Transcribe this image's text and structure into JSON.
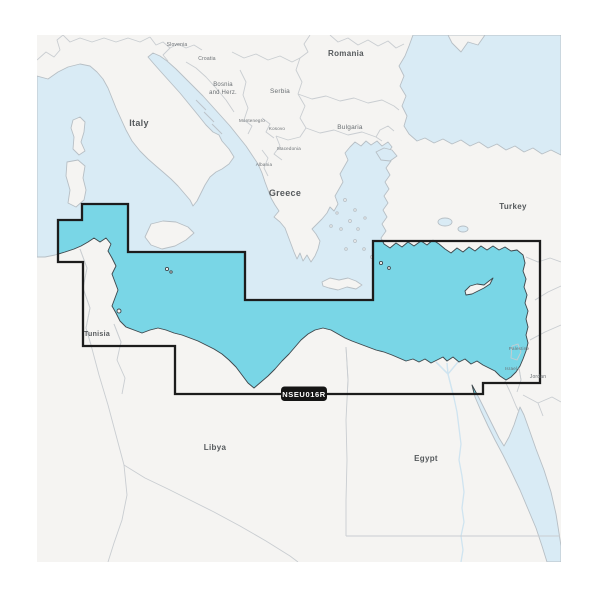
{
  "product": {
    "code": "NSEU016R",
    "region_type": "marine-chart-coverage"
  },
  "labels": {
    "slovenia": "Slovenia",
    "croatia": "Croatia",
    "bosnia_line1": "Bosnia",
    "bosnia_line2": "and Herz.",
    "serbia": "Serbia",
    "montenegro": "Montenegro",
    "kosovo": "Kosovo",
    "macedonia": "Macedonia",
    "albania": "Albania",
    "romania": "Romania",
    "bulgaria": "Bulgaria",
    "italy": "Italy",
    "greece": "Greece",
    "turkey": "Turkey",
    "tunisia": "Tunisia",
    "libya": "Libya",
    "egypt": "Egypt",
    "palestine": "Palestine",
    "israel": "Israel",
    "jordan": "Jordan"
  },
  "colors": {
    "covered_sea": "#79d6e6",
    "open_sea": "#d9ebf5",
    "land": "#f5f4f2",
    "coverage_outline": "#1c1c1c",
    "badge_background": "#151515",
    "badge_text": "#ffffff",
    "label_text": "#55595c"
  }
}
